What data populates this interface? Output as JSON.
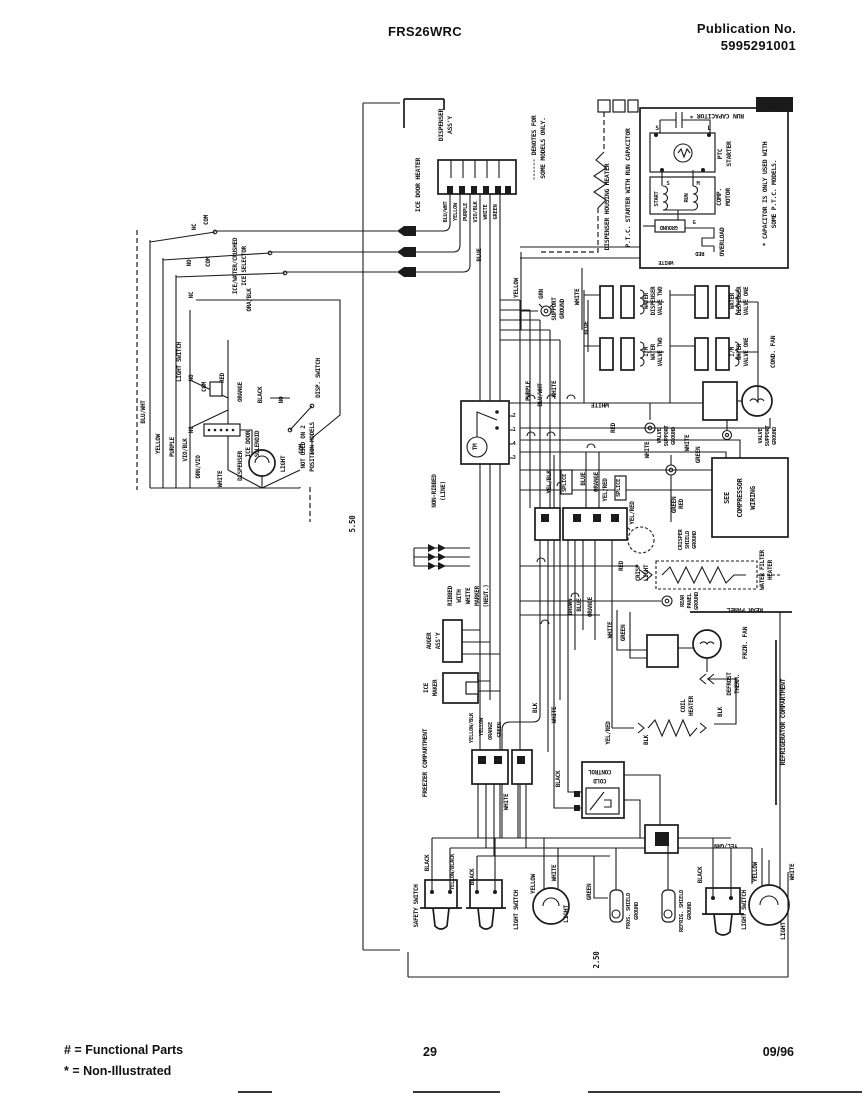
{
  "header": {
    "model": "FRS26WRC",
    "publication_label": "Publication No.",
    "publication_number": "5995291001"
  },
  "footer": {
    "functional_note": "# = Functional Parts",
    "non_illustrated_note": "* = Non-Illustrated",
    "page_number": "29",
    "date": "09/96"
  },
  "diagram": {
    "dimensions": {
      "height_in": "5.50",
      "width_in": "2.50"
    },
    "labels": [
      {
        "n": "lbl-dim-height",
        "t": "5.50",
        "x": 355,
        "y": 524,
        "s": 7.5
      },
      {
        "n": "lbl-dim-width",
        "t": "2.50",
        "x": 599,
        "y": 960,
        "s": 7.5
      },
      {
        "n": "lbl-ice-door-heater",
        "t": "ICE DOOR HEATER",
        "x": 420,
        "y": 185
      },
      {
        "n": "lbl-dispenser-assy-1",
        "t": "DISPENSER",
        "x": 443,
        "y": 125
      },
      {
        "n": "lbl-dispenser-assy-2",
        "t": "ASS'Y",
        "x": 452,
        "y": 125
      },
      {
        "t": "BLU/WHT",
        "x": 447,
        "y": 212,
        "s": 5.5
      },
      {
        "t": "YELLOW",
        "x": 457,
        "y": 212,
        "s": 5.5
      },
      {
        "t": "PURPLE",
        "x": 467,
        "y": 212,
        "s": 5.5
      },
      {
        "t": "VIO/BLK",
        "x": 477,
        "y": 212,
        "s": 5.5
      },
      {
        "t": "WHITE",
        "x": 487,
        "y": 212,
        "s": 5.5
      },
      {
        "t": "GREEN",
        "x": 497,
        "y": 212,
        "s": 5.5
      },
      {
        "t": "BLUE",
        "x": 481,
        "y": 255,
        "s": 6
      },
      {
        "n": "lbl-denotes-1",
        "t": "------ DENOTES FOR",
        "x": 536,
        "y": 148
      },
      {
        "n": "lbl-denotes-2",
        "t": "SOME MODELS ONLY.",
        "x": 545,
        "y": 148
      },
      {
        "t": "YELLOW",
        "x": 518,
        "y": 288,
        "s": 6
      },
      {
        "t": "GRN",
        "x": 543,
        "y": 294,
        "s": 6
      },
      {
        "t": "SUPPORT",
        "x": 556,
        "y": 309,
        "s": 6
      },
      {
        "t": "GROUND",
        "x": 564,
        "y": 309,
        "s": 6
      },
      {
        "t": "WHITE",
        "x": 579,
        "y": 297,
        "s": 6
      },
      {
        "t": "BLUE",
        "x": 588,
        "y": 328,
        "s": 6
      },
      {
        "n": "lbl-dispenser-housing-heater",
        "t": "DISPENSER HOUSING HEATER",
        "x": 609,
        "y": 207
      },
      {
        "n": "lbl-ptc-title",
        "t": "P.T.C. STARTER WITH RUN CAPACITOR",
        "x": 630,
        "y": 188
      },
      {
        "n": "lbl-run-capacitor",
        "t": "RUN CAPACITOR *",
        "x": 717,
        "y": 114,
        "r": 180
      },
      {
        "t": "PTC",
        "x": 722,
        "y": 154
      },
      {
        "t": "STARTER",
        "x": 731,
        "y": 154
      },
      {
        "t": "S",
        "x": 657,
        "y": 130,
        "r": 0,
        "s": 6
      },
      {
        "t": "L",
        "x": 709,
        "y": 130,
        "r": 0,
        "s": 6
      },
      {
        "t": "S",
        "x": 668,
        "y": 185,
        "r": 0,
        "s": 5.5
      },
      {
        "t": "M",
        "x": 698,
        "y": 185,
        "r": 0,
        "s": 5.5
      },
      {
        "t": "G",
        "x": 694,
        "y": 224,
        "r": 0,
        "s": 5.5
      },
      {
        "t": "START",
        "x": 658,
        "y": 199,
        "s": 5.5
      },
      {
        "t": "RUN",
        "x": 688,
        "y": 198,
        "s": 5.5
      },
      {
        "t": "COMP.",
        "x": 721,
        "y": 197
      },
      {
        "t": "MOTOR",
        "x": 730,
        "y": 197
      },
      {
        "t": "OVERLOAD",
        "x": 724,
        "y": 242
      },
      {
        "t": "GROUND",
        "x": 669,
        "y": 226,
        "r": 180,
        "s": 5.5
      },
      {
        "t": "RED",
        "x": 700,
        "y": 252,
        "r": 180,
        "s": 5.5
      },
      {
        "t": "WHITE",
        "x": 666,
        "y": 261,
        "r": 180,
        "s": 5.5
      },
      {
        "n": "lbl-capacitor-note-1",
        "t": "* CAPACITOR IS ONLY USED WITH",
        "x": 767,
        "y": 194
      },
      {
        "n": "lbl-capacitor-note-2",
        "t": "SOME P.T.C. MODELS.",
        "x": 776,
        "y": 194
      },
      {
        "n": "lbl-diagram-number",
        "t": "2189612",
        "x": 774,
        "y": 105,
        "r": 180,
        "s": 5,
        "c": "#ffffff"
      },
      {
        "t": "WATER",
        "x": 648,
        "y": 301,
        "s": 5.8
      },
      {
        "t": "DISPENSER",
        "x": 655,
        "y": 301,
        "s": 5.8
      },
      {
        "t": "VALVE TWO",
        "x": 662,
        "y": 301,
        "s": 5.8
      },
      {
        "t": "WATER",
        "x": 734,
        "y": 301,
        "s": 5.8
      },
      {
        "t": "DISPENSER",
        "x": 741,
        "y": 301,
        "s": 5.8
      },
      {
        "t": "VALVE ONE",
        "x": 748,
        "y": 301,
        "s": 5.8
      },
      {
        "t": "I/M",
        "x": 648,
        "y": 352,
        "s": 5.8
      },
      {
        "t": "WATER",
        "x": 655,
        "y": 352,
        "s": 5.8
      },
      {
        "t": "VALVE TWO",
        "x": 662,
        "y": 352,
        "s": 5.8
      },
      {
        "t": "I/M",
        "x": 734,
        "y": 352,
        "s": 5.8
      },
      {
        "t": "WATER",
        "x": 741,
        "y": 352,
        "s": 5.8
      },
      {
        "t": "VALVE ONE",
        "x": 748,
        "y": 352,
        "s": 5.8
      },
      {
        "n": "lbl-cond-fan",
        "t": "COND. FAN",
        "x": 775,
        "y": 352
      },
      {
        "t": "VALVE",
        "x": 661,
        "y": 436,
        "s": 5.5
      },
      {
        "t": "SUPPORT",
        "x": 668,
        "y": 436,
        "s": 5.5
      },
      {
        "t": "GROUND",
        "x": 675,
        "y": 436,
        "s": 5.5
      },
      {
        "t": "VALVE",
        "x": 762,
        "y": 436,
        "s": 5.5
      },
      {
        "t": "SUPPORT",
        "x": 769,
        "y": 436,
        "s": 5.5
      },
      {
        "t": "GROUND",
        "x": 776,
        "y": 436,
        "s": 5.5
      },
      {
        "n": "lbl-see-compressor-1",
        "t": "SEE",
        "x": 729,
        "y": 498,
        "s": 7
      },
      {
        "n": "lbl-see-compressor-2",
        "t": "COMPRESSOR",
        "x": 742,
        "y": 498,
        "s": 7
      },
      {
        "n": "lbl-see-compressor-3",
        "t": "WIRING",
        "x": 755,
        "y": 498,
        "s": 7
      },
      {
        "n": "lbl-water-filter-1",
        "t": "WATER FILTER",
        "x": 764,
        "y": 570,
        "s": 6
      },
      {
        "n": "lbl-water-filter-2",
        "t": "HEATER",
        "x": 772,
        "y": 570,
        "s": 6
      },
      {
        "t": "CRISP",
        "x": 640,
        "y": 573,
        "s": 6
      },
      {
        "t": "LIGHT",
        "x": 648,
        "y": 573,
        "s": 6
      },
      {
        "t": "CRISPER",
        "x": 682,
        "y": 540,
        "s": 5.5
      },
      {
        "t": "SHIELD",
        "x": 689,
        "y": 540,
        "s": 5.5
      },
      {
        "t": "GROUND",
        "x": 696,
        "y": 540,
        "s": 5.5
      },
      {
        "t": "GREEN",
        "x": 676,
        "y": 505,
        "s": 6
      },
      {
        "t": "REAR",
        "x": 684,
        "y": 601,
        "s": 5.5
      },
      {
        "t": "PANEL",
        "x": 691,
        "y": 601,
        "s": 5.5
      },
      {
        "t": "GROUND",
        "x": 698,
        "y": 601,
        "s": 5.5
      },
      {
        "n": "lbl-rear-panel",
        "t": "REAR PANEL",
        "x": 745,
        "y": 608,
        "r": 180
      },
      {
        "n": "lbl-frzr-fan",
        "t": "FRZR. FAN",
        "x": 747,
        "y": 643
      },
      {
        "t": "DEFROST",
        "x": 731,
        "y": 684,
        "s": 6
      },
      {
        "t": "THERM.",
        "x": 739,
        "y": 684,
        "s": 6
      },
      {
        "t": "COIL",
        "x": 685,
        "y": 706,
        "s": 6
      },
      {
        "t": "HEATER",
        "x": 693,
        "y": 706,
        "s": 6
      },
      {
        "t": "BLK",
        "x": 722,
        "y": 712,
        "s": 6
      },
      {
        "t": "BLK",
        "x": 648,
        "y": 740,
        "s": 6
      },
      {
        "t": "YEL/RED",
        "x": 610,
        "y": 733,
        "s": 6
      },
      {
        "n": "lbl-refrigerator-compartment",
        "t": "REFRIGERATOR COMPARTMENT",
        "x": 785,
        "y": 722
      },
      {
        "n": "lbl-freezer-compartment",
        "t": "FREEZER COMPARTMENT",
        "x": 427,
        "y": 763
      },
      {
        "n": "lbl-cold-control-1",
        "t": "CONTROL",
        "x": 600,
        "y": 770,
        "r": 180,
        "s": 6
      },
      {
        "n": "lbl-cold-control-2",
        "t": "COLD",
        "x": 600,
        "y": 779,
        "r": 180,
        "s": 6
      },
      {
        "t": "BLACK",
        "x": 560,
        "y": 779,
        "s": 6
      },
      {
        "t": "BLK",
        "x": 537,
        "y": 708,
        "s": 6
      },
      {
        "t": "WHITE",
        "x": 556,
        "y": 715,
        "s": 6
      },
      {
        "t": "WHITE",
        "x": 508,
        "y": 802,
        "s": 6
      },
      {
        "t": "YELLOW/BLK",
        "x": 473,
        "y": 728,
        "s": 5.5
      },
      {
        "t": "YELLOW",
        "x": 483,
        "y": 727,
        "s": 5.5
      },
      {
        "t": "ORANGE",
        "x": 492,
        "y": 731,
        "s": 5.5
      },
      {
        "t": "GREEN",
        "x": 501,
        "y": 730,
        "s": 5.5
      },
      {
        "t": "RIBBED",
        "x": 452,
        "y": 596,
        "s": 6
      },
      {
        "t": "WITH",
        "x": 461,
        "y": 596,
        "s": 6
      },
      {
        "t": "WHITE",
        "x": 470,
        "y": 596,
        "s": 6
      },
      {
        "t": "MARKER",
        "x": 479,
        "y": 596,
        "s": 6
      },
      {
        "t": "(NEUT.)",
        "x": 488,
        "y": 596,
        "s": 6
      },
      {
        "t": "NON-RIBBED",
        "x": 436,
        "y": 491,
        "s": 6
      },
      {
        "t": "(LINE)",
        "x": 445,
        "y": 491,
        "s": 6
      },
      {
        "n": "lbl-auger-1",
        "t": "AUGER",
        "x": 431,
        "y": 641,
        "s": 6
      },
      {
        "n": "lbl-auger-2",
        "t": "ASS'Y",
        "x": 440,
        "y": 641,
        "s": 6
      },
      {
        "n": "lbl-ice-maker-1",
        "t": "ICE",
        "x": 428,
        "y": 688,
        "s": 6
      },
      {
        "n": "lbl-ice-maker-2",
        "t": "MAKER",
        "x": 437,
        "y": 688,
        "s": 6
      },
      {
        "t": "2",
        "x": 514,
        "y": 417,
        "r": 0,
        "s": 5.5
      },
      {
        "t": "1",
        "x": 514,
        "y": 431,
        "r": 0,
        "s": 5.5
      },
      {
        "t": "4",
        "x": 514,
        "y": 445,
        "r": 0,
        "s": 5.5
      },
      {
        "t": "3",
        "x": 514,
        "y": 459,
        "r": 0,
        "s": 5.5
      },
      {
        "n": "lbl-timer",
        "t": "TM",
        "x": 477,
        "y": 447,
        "s": 6
      },
      {
        "t": "PURPLE",
        "x": 530,
        "y": 391,
        "s": 6
      },
      {
        "t": "BLU/WHT",
        "x": 542,
        "y": 395,
        "s": 6
      },
      {
        "t": "WHITE",
        "x": 556,
        "y": 389,
        "s": 6
      },
      {
        "n": "lbl-white-flip",
        "t": "WHITE",
        "x": 600,
        "y": 403,
        "r": 180
      },
      {
        "t": "RED",
        "x": 615,
        "y": 428,
        "s": 6
      },
      {
        "t": "YEL/BLK",
        "x": 551,
        "y": 482,
        "s": 6
      },
      {
        "t": "SPLICE",
        "x": 566,
        "y": 483,
        "s": 5.5
      },
      {
        "t": "BLUE",
        "x": 585,
        "y": 479,
        "s": 6
      },
      {
        "t": "ORANGE",
        "x": 598,
        "y": 482,
        "s": 6
      },
      {
        "t": "YEL/RED",
        "x": 607,
        "y": 490,
        "s": 6
      },
      {
        "t": "SPLICE",
        "x": 620,
        "y": 488,
        "s": 5.5
      },
      {
        "t": "YEL/RED",
        "x": 634,
        "y": 513,
        "s": 6
      },
      {
        "t": "WHITE",
        "x": 649,
        "y": 450,
        "s": 6
      },
      {
        "t": "WHITE",
        "x": 689,
        "y": 443,
        "s": 6
      },
      {
        "t": "GREEN",
        "x": 700,
        "y": 455,
        "s": 6
      },
      {
        "t": "RED",
        "x": 683,
        "y": 504,
        "s": 6
      },
      {
        "t": "RED",
        "x": 623,
        "y": 566,
        "s": 6
      },
      {
        "t": "WHITE",
        "x": 612,
        "y": 630,
        "s": 6
      },
      {
        "t": "GREEN",
        "x": 625,
        "y": 633,
        "s": 6
      },
      {
        "t": "BROWN",
        "x": 572,
        "y": 607,
        "s": 6
      },
      {
        "t": "BLUE",
        "x": 581,
        "y": 605,
        "s": 6
      },
      {
        "t": "ORANGE",
        "x": 592,
        "y": 607,
        "s": 6
      },
      {
        "t": "BLACK",
        "x": 429,
        "y": 863,
        "s": 6
      },
      {
        "t": "YELLOW/BLACK",
        "x": 454,
        "y": 872,
        "s": 5.5
      },
      {
        "n": "lbl-safety-switch",
        "t": "SAFETY SWITCH",
        "x": 418,
        "y": 906,
        "s": 6
      },
      {
        "t": "BLACK",
        "x": 474,
        "y": 877,
        "s": 6
      },
      {
        "n": "lbl-light-switch-1",
        "t": "LIGHT SWITCH",
        "x": 518,
        "y": 910,
        "s": 6
      },
      {
        "t": "YELLOW",
        "x": 535,
        "y": 884,
        "s": 6
      },
      {
        "t": "WHITE",
        "x": 556,
        "y": 873,
        "s": 6
      },
      {
        "n": "lbl-light-1",
        "t": "LIGHT",
        "x": 568,
        "y": 914
      },
      {
        "t": "GREEN",
        "x": 591,
        "y": 892,
        "s": 6
      },
      {
        "n": "lbl-fros-shield-1",
        "t": "FROS. SHIELD",
        "x": 630,
        "y": 911,
        "s": 5.5
      },
      {
        "n": "lbl-fros-shield-2",
        "t": "GROUND",
        "x": 638,
        "y": 911,
        "s": 5.5
      },
      {
        "n": "lbl-refrig-shield-1",
        "t": "REFRIG. SHIELD",
        "x": 683,
        "y": 911,
        "s": 5.5
      },
      {
        "n": "lbl-refrig-shield-2",
        "t": "GROUND",
        "x": 691,
        "y": 911,
        "s": 5.5
      },
      {
        "t": "BLACK",
        "x": 702,
        "y": 875,
        "s": 6
      },
      {
        "n": "lbl-yel-grn",
        "t": "YEL/GRN",
        "x": 726,
        "y": 844,
        "r": 180,
        "s": 6
      },
      {
        "n": "lbl-light-switch-2",
        "t": "LIGHT SWITCH",
        "x": 746,
        "y": 910,
        "s": 6
      },
      {
        "t": "YELLOW",
        "x": 757,
        "y": 872,
        "s": 6
      },
      {
        "t": "WHITE",
        "x": 794,
        "y": 872,
        "s": 6
      },
      {
        "n": "lbl-light-2",
        "t": "LIGHT",
        "x": 785,
        "y": 931
      },
      {
        "t": "NC",
        "x": 196,
        "y": 227,
        "s": 6
      },
      {
        "t": "COM",
        "x": 208,
        "y": 220,
        "s": 6
      },
      {
        "t": "NO",
        "x": 191,
        "y": 263,
        "s": 6
      },
      {
        "t": "COM",
        "x": 210,
        "y": 262,
        "s": 6
      },
      {
        "t": "NC",
        "x": 193,
        "y": 295,
        "s": 6
      },
      {
        "n": "lbl-selector-1",
        "t": "ICE/WATER/CRUSHED",
        "x": 237,
        "y": 266,
        "s": 6
      },
      {
        "n": "lbl-selector-2",
        "t": "ICE SELECTOR",
        "x": 246,
        "y": 266,
        "s": 6
      },
      {
        "t": "ORA/BLK",
        "x": 251,
        "y": 300,
        "s": 6
      },
      {
        "n": "lbl-disp-light-switch",
        "t": "LIGHT SWITCH",
        "x": 181,
        "y": 362,
        "s": 6
      },
      {
        "t": "NO",
        "x": 193,
        "y": 378,
        "s": 6
      },
      {
        "t": "COM",
        "x": 206,
        "y": 387,
        "s": 6
      },
      {
        "t": "NC",
        "x": 193,
        "y": 430,
        "s": 6
      },
      {
        "t": "NO",
        "x": 283,
        "y": 400,
        "s": 6
      },
      {
        "n": "lbl-disp-switch",
        "t": "DISP. SWITCH",
        "x": 320,
        "y": 378,
        "s": 6
      },
      {
        "t": "COM",
        "x": 303,
        "y": 449,
        "s": 6
      },
      {
        "t": "RED",
        "x": 224,
        "y": 378,
        "s": 6
      },
      {
        "t": "ORANGE",
        "x": 242,
        "y": 392,
        "s": 6
      },
      {
        "t": "BLACK",
        "x": 262,
        "y": 395,
        "s": 6
      },
      {
        "n": "lbl-ice-door-solenoid-1",
        "t": "ICE DOOR",
        "x": 250,
        "y": 444,
        "s": 6
      },
      {
        "n": "lbl-ice-door-solenoid-2",
        "t": "SOLENOID",
        "x": 259,
        "y": 444,
        "s": 6
      },
      {
        "n": "lbl-dispenser",
        "t": "DISPENSER",
        "x": 242,
        "y": 466,
        "s": 6
      },
      {
        "n": "lbl-disp-light",
        "t": "LIGHT",
        "x": 285,
        "y": 464,
        "s": 6
      },
      {
        "t": "WHITE",
        "x": 222,
        "y": 479,
        "s": 6
      },
      {
        "t": "BLU/WHT",
        "x": 145,
        "y": 412,
        "s": 6
      },
      {
        "t": "YELLOW",
        "x": 160,
        "y": 444,
        "s": 6
      },
      {
        "t": "PURPLE",
        "x": 174,
        "y": 447,
        "s": 6
      },
      {
        "t": "VIO/BLK",
        "x": 187,
        "y": 450,
        "s": 6
      },
      {
        "t": "ORN/VIO",
        "x": 200,
        "y": 467,
        "s": 6
      },
      {
        "n": "lbl-not-used-1",
        "t": "NOT USED ON 2",
        "x": 305,
        "y": 447,
        "s": 6
      },
      {
        "n": "lbl-not-used-2",
        "t": "POSITION MODELS",
        "x": 314,
        "y": 447,
        "s": 6
      }
    ]
  }
}
